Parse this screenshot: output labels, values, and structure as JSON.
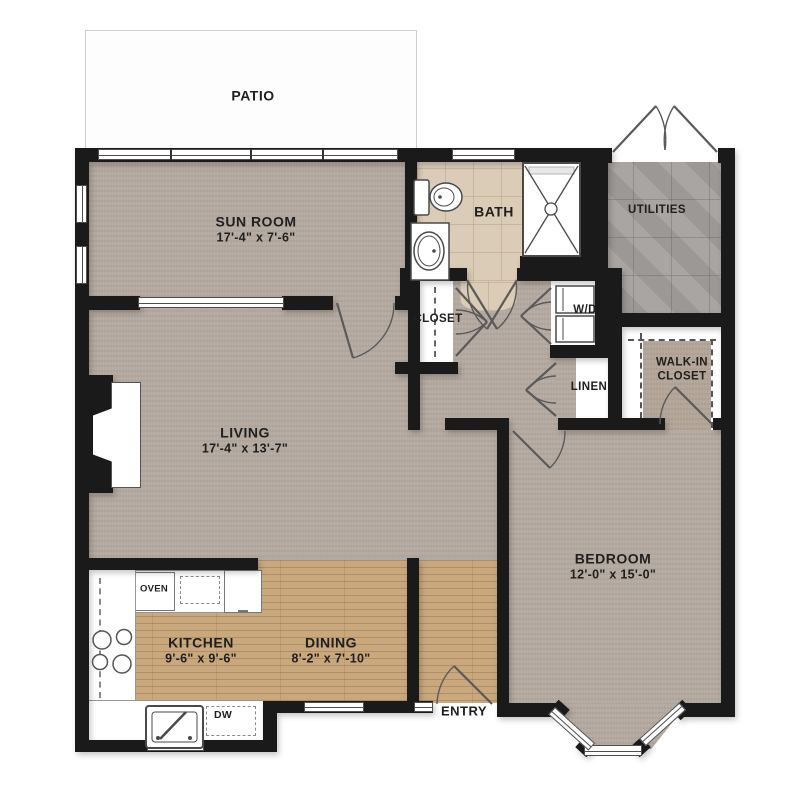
{
  "rooms": {
    "patio": {
      "label": "PATIO"
    },
    "sun_room": {
      "label": "SUN ROOM",
      "dims": "17'-4\" x 7'-6\""
    },
    "bath": {
      "label": "BATH"
    },
    "utilities": {
      "label": "UTILITIES"
    },
    "closet": {
      "label": "CLOSET"
    },
    "washer_dryer": {
      "label": "W/D"
    },
    "linen": {
      "label": "LINEN"
    },
    "walk_in_closet": {
      "line1": "WALK-IN",
      "line2": "CLOSET"
    },
    "living": {
      "label": "LIVING",
      "dims": "17'-4\" x 13'-7\""
    },
    "bedroom": {
      "label": "BEDROOM",
      "dims": "12'-0\" x 15'-0\""
    },
    "kitchen": {
      "label": "KITCHEN",
      "dims": "9'-6\" x 9'-6\""
    },
    "dining": {
      "label": "DINING",
      "dims": "8'-2\" x 7'-10\""
    },
    "entry": {
      "label": "ENTRY"
    }
  },
  "appliances": {
    "oven": "OVEN",
    "dishwasher": "DW"
  },
  "colors": {
    "wall": "#1a1a1a",
    "carpet": "#b5aaa1",
    "wood": "#c9a87e",
    "bath_tile": "#dbccb8",
    "utility_tile": "#a3a09d",
    "patio": "#fdfdfd"
  }
}
